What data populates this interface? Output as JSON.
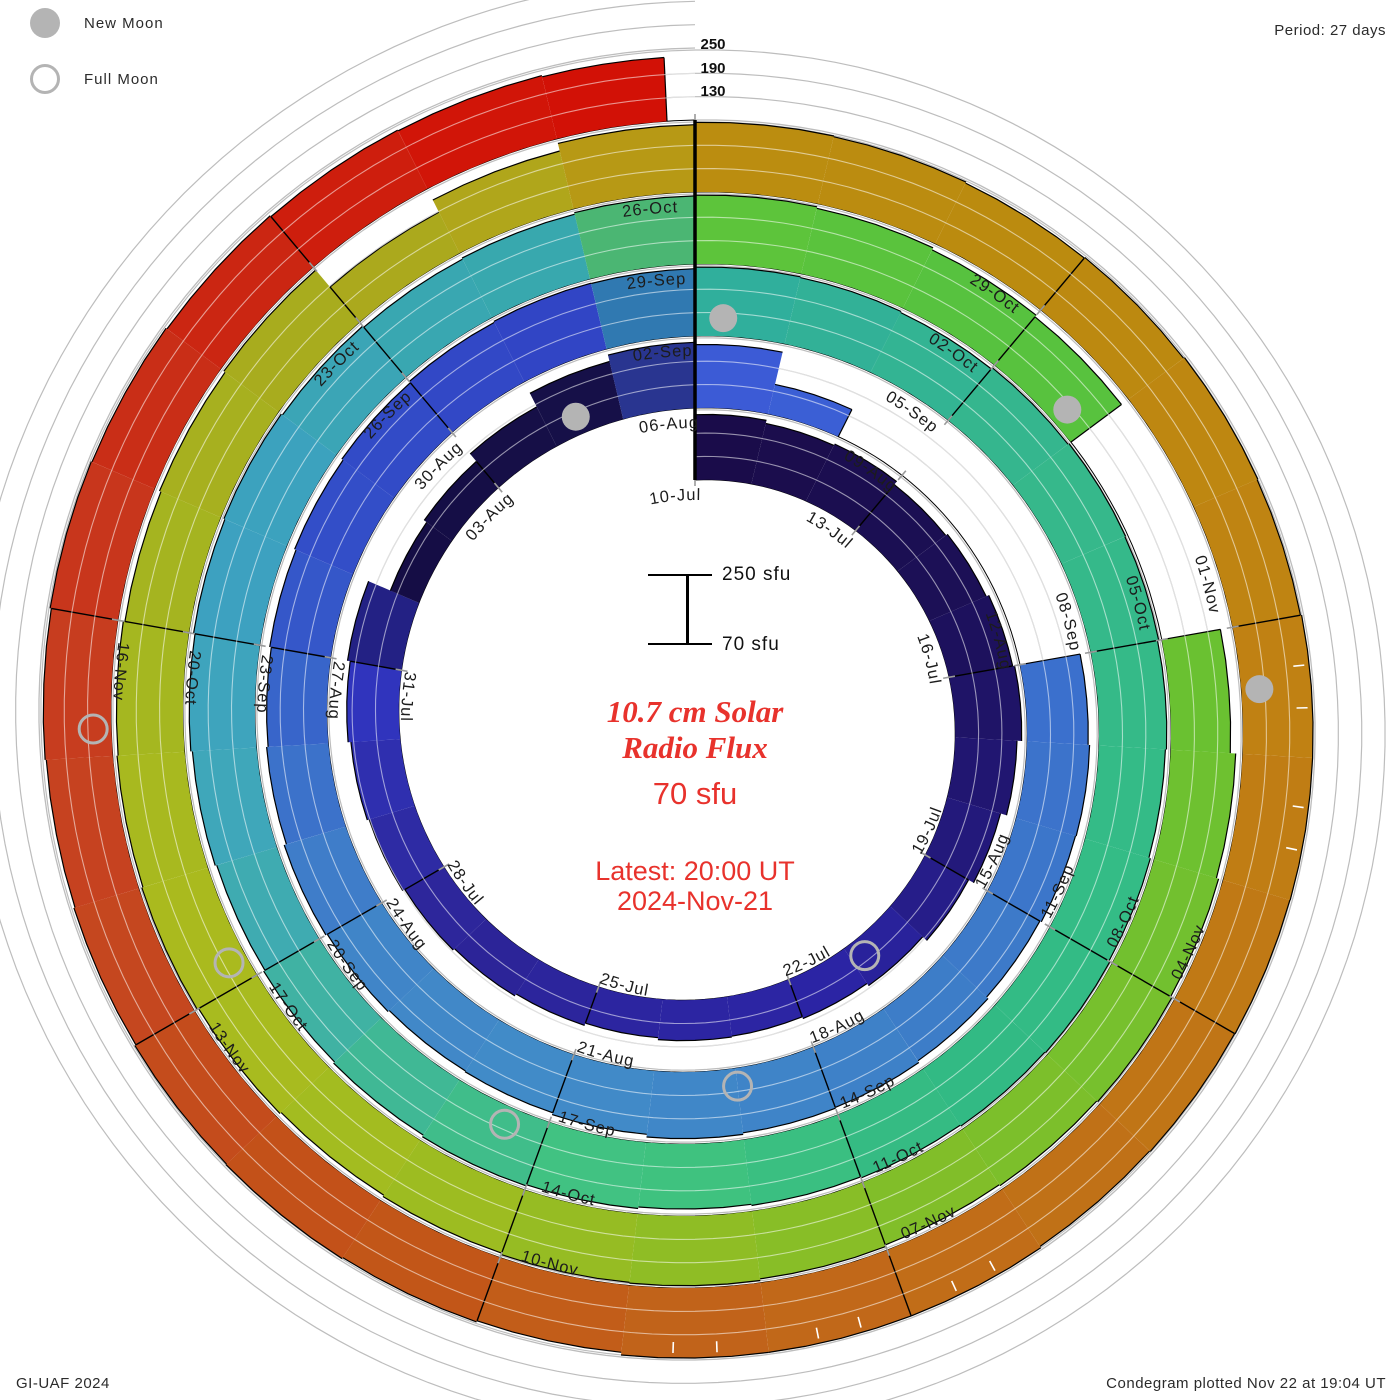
{
  "header": {
    "period_label": "Period: 27 days",
    "credit_label": "GI-UAF 2024",
    "plotted_label": "Condegram plotted Nov 22 at 19:04 UT"
  },
  "legend": {
    "new_moon_label": "New Moon",
    "full_moon_label": "Full Moon"
  },
  "center": {
    "title_line1": "10.7 cm Solar",
    "title_line2": "Radio Flux",
    "value_label": "70 sfu",
    "latest_line1": "Latest: 20:00 UT",
    "latest_line2": "2024-Nov-21"
  },
  "scale_bar": {
    "top_label": "250 sfu",
    "bottom_label": "70 sfu"
  },
  "colors": {
    "accent_red": "#e8322c",
    "moon_gray": "#b4b4b4",
    "grid_gray": "#bdbdbd",
    "label_dark": "#1c1c1c"
  },
  "chart_data": {
    "type": "spiral-polar-bar-condegram",
    "title": "10.7 cm Solar Radio Flux",
    "units": "sfu",
    "period_days": 27,
    "start_date": "2024-07-10",
    "end_date": "2024-11-21",
    "baseline_value": 70,
    "max_value": 250,
    "radial_gridlines": [
      130,
      190,
      250
    ],
    "radial_axis_labels": [
      "250",
      "190",
      "130"
    ],
    "date_labels": [
      {
        "day": 0,
        "text": "10-Jul"
      },
      {
        "day": 3,
        "text": "13-Jul"
      },
      {
        "day": 6,
        "text": "16-Jul"
      },
      {
        "day": 9,
        "text": "19-Jul"
      },
      {
        "day": 12,
        "text": "22-Jul"
      },
      {
        "day": 15,
        "text": "25-Jul"
      },
      {
        "day": 18,
        "text": "28-Jul"
      },
      {
        "day": 21,
        "text": "31-Jul"
      },
      {
        "day": 24,
        "text": "03-Aug"
      },
      {
        "day": 27,
        "text": "06-Aug"
      },
      {
        "day": 30,
        "text": "09-Aug"
      },
      {
        "day": 33,
        "text": "12-Aug"
      },
      {
        "day": 36,
        "text": "15-Aug"
      },
      {
        "day": 39,
        "text": "18-Aug"
      },
      {
        "day": 42,
        "text": "21-Aug"
      },
      {
        "day": 45,
        "text": "24-Aug"
      },
      {
        "day": 48,
        "text": "27-Aug"
      },
      {
        "day": 51,
        "text": "30-Aug"
      },
      {
        "day": 54,
        "text": "02-Sep"
      },
      {
        "day": 57,
        "text": "05-Sep"
      },
      {
        "day": 60,
        "text": "08-Sep"
      },
      {
        "day": 63,
        "text": "11-Sep"
      },
      {
        "day": 66,
        "text": "14-Sep"
      },
      {
        "day": 69,
        "text": "17-Sep"
      },
      {
        "day": 72,
        "text": "20-Sep"
      },
      {
        "day": 75,
        "text": "23-Sep"
      },
      {
        "day": 78,
        "text": "26-Sep"
      },
      {
        "day": 81,
        "text": "29-Sep"
      },
      {
        "day": 84,
        "text": "02-Oct"
      },
      {
        "day": 87,
        "text": "05-Oct"
      },
      {
        "day": 90,
        "text": "08-Oct"
      },
      {
        "day": 93,
        "text": "11-Oct"
      },
      {
        "day": 96,
        "text": "14-Oct"
      },
      {
        "day": 99,
        "text": "17-Oct"
      },
      {
        "day": 102,
        "text": "20-Oct"
      },
      {
        "day": 105,
        "text": "23-Oct"
      },
      {
        "day": 108,
        "text": "26-Oct"
      },
      {
        "day": 111,
        "text": "29-Oct"
      },
      {
        "day": 114,
        "text": "01-Nov"
      },
      {
        "day": 117,
        "text": "04-Nov"
      },
      {
        "day": 120,
        "text": "07-Nov"
      },
      {
        "day": 123,
        "text": "10-Nov"
      },
      {
        "day": 126,
        "text": "13-Nov"
      },
      {
        "day": 129,
        "text": "16-Nov"
      }
    ],
    "daily_flux_sfu": [
      238,
      230,
      234,
      224,
      229,
      236,
      241,
      229,
      213,
      198,
      184,
      177,
      172,
      174,
      169,
      175,
      181,
      186,
      192,
      197,
      204,
      211,
      150,
      158,
      183,
      222,
      239,
      233,
      148,
      null,
      null,
      null,
      null,
      227,
      231,
      229,
      225,
      230,
      235,
      237,
      241,
      234,
      229,
      227,
      231,
      235,
      229,
      225,
      229,
      233,
      237,
      241,
      244,
      243,
      247,
      245,
      242,
      246,
      249,
      247,
      244,
      241,
      245,
      248,
      246,
      243,
      240,
      237,
      241,
      244,
      239,
      235,
      231,
      235,
      239,
      243,
      246,
      242,
      238,
      241,
      245,
      247,
      243,
      237,
      232,
      null,
      null,
      223,
      237,
      243,
      247,
      244,
      241,
      245,
      249,
      247,
      243,
      239,
      243,
      247,
      244,
      241,
      237,
      241,
      245,
      188,
      223,
      243,
      249,
      247,
      244,
      246,
      249,
      247,
      252,
      253,
      249,
      248,
      246,
      251,
      252,
      251,
      243,
      246,
      249,
      247,
      244,
      241,
      244,
      247,
      245,
      242,
      239,
      237,
      234
    ],
    "color_stops": [
      [
        0,
        "#1a0c48"
      ],
      [
        5,
        "#1c1058"
      ],
      [
        9,
        "#241a80"
      ],
      [
        11,
        "#2b24a4"
      ],
      [
        14,
        "#2c25a2"
      ],
      [
        17,
        "#2c2496"
      ],
      [
        19,
        "#2e2da8"
      ],
      [
        21,
        "#3136c4"
      ],
      [
        22,
        "#150c44"
      ],
      [
        26,
        "#161049"
      ],
      [
        27,
        "#3c59d6"
      ],
      [
        31,
        "#3a68d2"
      ],
      [
        35,
        "#3c74ca"
      ],
      [
        38,
        "#3d7fc8"
      ],
      [
        42,
        "#418cc8"
      ],
      [
        45,
        "#4083c8"
      ],
      [
        47,
        "#3a6cca"
      ],
      [
        49,
        "#3350c8"
      ],
      [
        53,
        "#3143c4"
      ],
      [
        54,
        "#2fae9e"
      ],
      [
        58,
        "#36b78c"
      ],
      [
        62,
        "#34bc86"
      ],
      [
        65,
        "#32b984"
      ],
      [
        68,
        "#41c47e"
      ],
      [
        70,
        "#40bb8e"
      ],
      [
        73,
        "#3fa8b8"
      ],
      [
        76,
        "#3da0c2"
      ],
      [
        78,
        "#3aa6b2"
      ],
      [
        80,
        "#37a8ac"
      ],
      [
        81,
        "#5ec43a"
      ],
      [
        84,
        "#55c240"
      ],
      [
        87,
        "#68c132"
      ],
      [
        90,
        "#74c02e"
      ],
      [
        93,
        "#84be28"
      ],
      [
        96,
        "#9abc22"
      ],
      [
        99,
        "#abbb1e"
      ],
      [
        102,
        "#a4b620"
      ],
      [
        105,
        "#a9aa1e"
      ],
      [
        107,
        "#b2a41a"
      ],
      [
        108,
        "#bb8e10"
      ],
      [
        111,
        "#bb8a0f"
      ],
      [
        114,
        "#c08312"
      ],
      [
        118,
        "#c07316"
      ],
      [
        121,
        "#c1661a"
      ],
      [
        124,
        "#c25318"
      ],
      [
        127,
        "#c54520"
      ],
      [
        129,
        "#c73a1e"
      ],
      [
        131,
        "#ca2a14"
      ],
      [
        134,
        "#d21106"
      ]
    ],
    "moons": {
      "new_moon_days": [
        {
          "date": "04-Aug",
          "day": 25.4
        },
        {
          "date": "02-Sep",
          "day": 54.3
        },
        {
          "date": "02-Oct",
          "day": 84.75
        },
        {
          "date": "01-Nov",
          "day": 114.5
        }
      ],
      "full_moon_days": [
        {
          "date": "21-Jul",
          "day": 10.8
        },
        {
          "date": "19-Aug",
          "day": 40.0
        },
        {
          "date": "17-Sep",
          "day": 69.4
        },
        {
          "date": "17-Oct",
          "day": 99.2
        },
        {
          "date": "15-Nov",
          "day": 128.2
        }
      ]
    },
    "layout_hints": {
      "direction": "clockwise-from-top",
      "one_turn_days": 27,
      "grid": "on",
      "legend_position": "top-left"
    }
  }
}
